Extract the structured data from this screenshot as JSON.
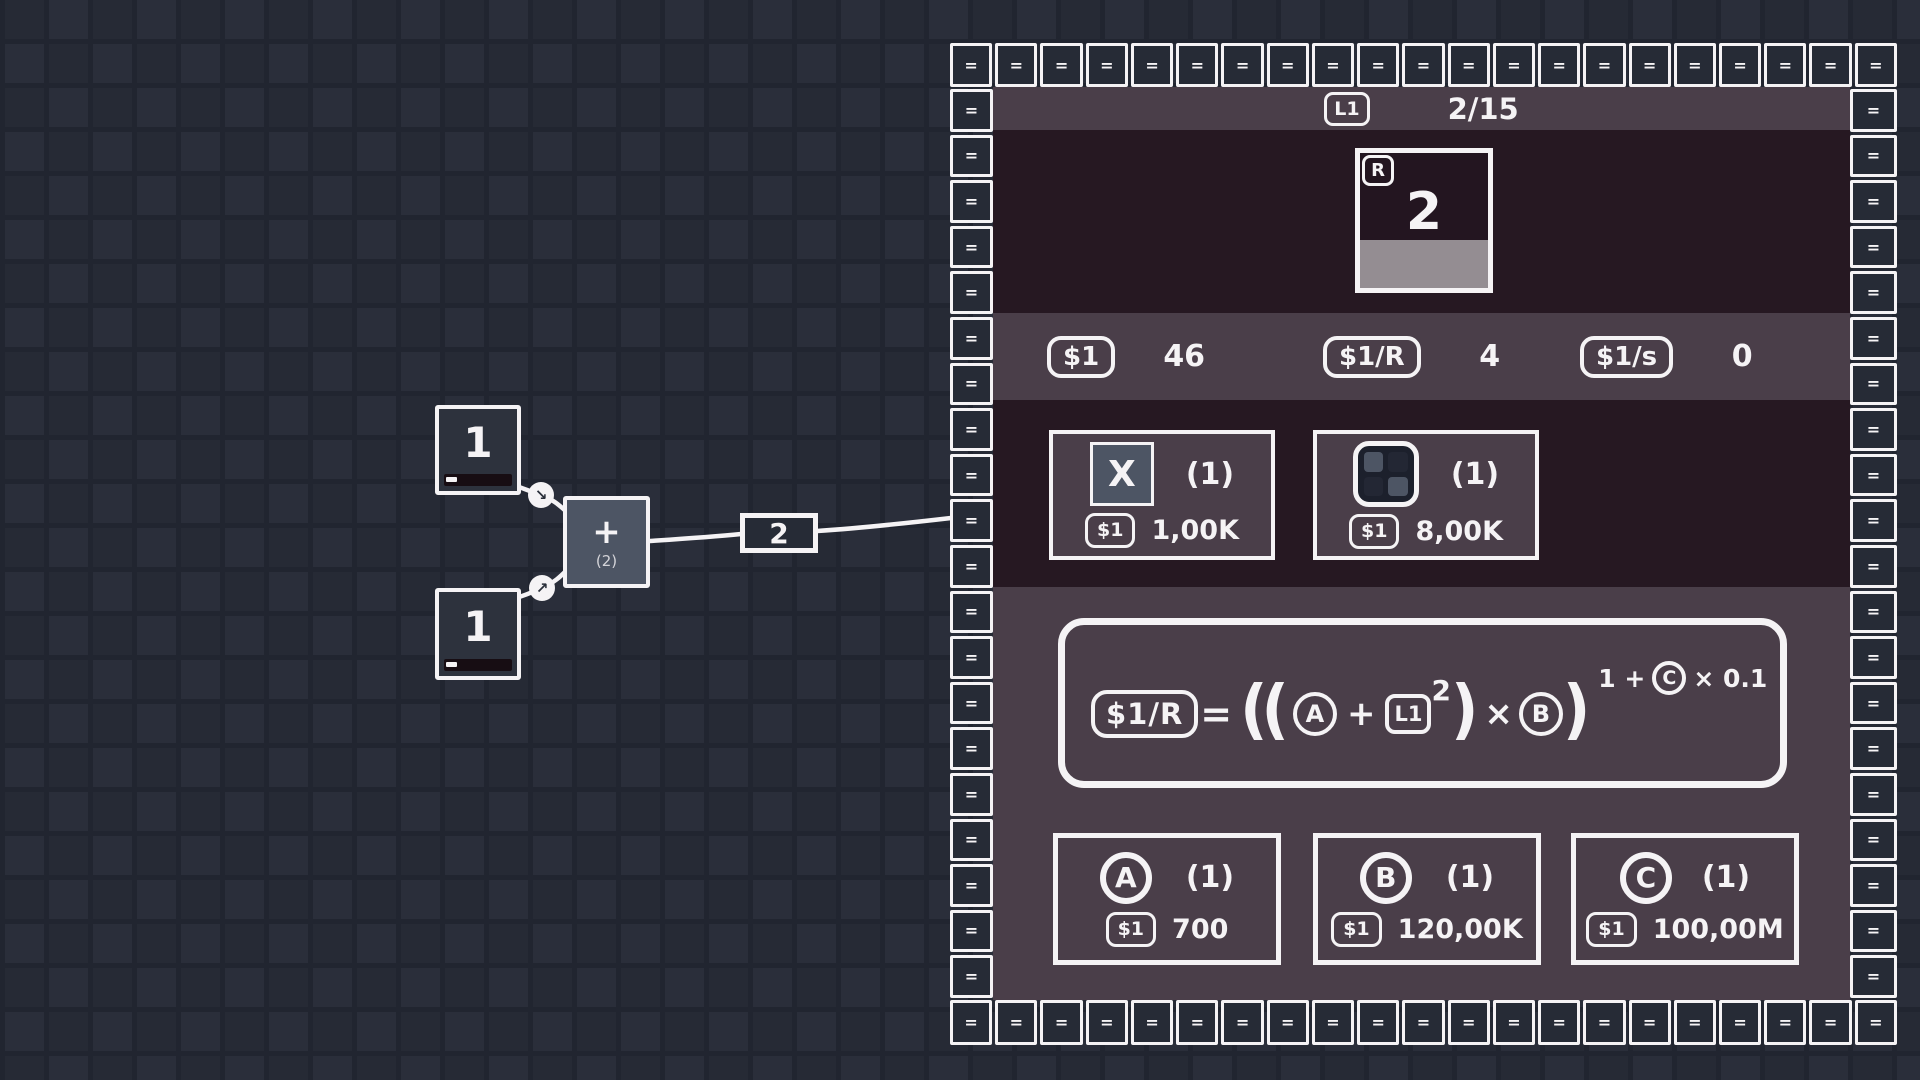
{
  "colors": {
    "background": "#242834",
    "panel_mauve": "#4a3e49",
    "panel_dark_purple": "#261822",
    "slate_accent": "#4d5564",
    "progress_gray": "#948d92",
    "stroke_white": "#f5f3f5"
  },
  "graph": {
    "input_nodes": [
      {
        "value": "1"
      },
      {
        "value": "1"
      }
    ],
    "operator_node": {
      "symbol": "+",
      "annotation": "(2)"
    },
    "edge_value_label": "2",
    "connector_arrows": [
      {
        "name": "arrow-down-right-icon",
        "glyph": "↘"
      },
      {
        "name": "arrow-up-right-icon",
        "glyph": "↗"
      }
    ]
  },
  "panel": {
    "border_tile_glyph": "=",
    "header": {
      "level_badge": "L1",
      "progress": "2/15"
    },
    "card": {
      "corner_badge": "R",
      "value": "2"
    },
    "stats": [
      {
        "unit": "$1",
        "value": "46"
      },
      {
        "unit": "$1/R",
        "value": "4"
      },
      {
        "unit": "$1/s",
        "value": "0"
      }
    ],
    "upgrades": [
      {
        "icon": "x-icon",
        "icon_label": "X",
        "count": "(1)",
        "currency": "$1",
        "cost": "1,00K"
      },
      {
        "icon": "grid-icon",
        "count": "(1)",
        "currency": "$1",
        "cost": "8,00K"
      }
    ],
    "formula": {
      "result": "$1/R",
      "equals": "=",
      "open": "((",
      "var_a": "A",
      "plus": "+",
      "var_l1": "L1",
      "square": "2",
      "close1": ")",
      "times": "×",
      "var_b": "B",
      "close2": ")",
      "exp_pre": "1 +",
      "exp_var": "C",
      "exp_post": "× 0.1"
    },
    "buy_buttons": [
      {
        "letter": "A",
        "count": "(1)",
        "currency": "$1",
        "cost": "700"
      },
      {
        "letter": "B",
        "count": "(1)",
        "currency": "$1",
        "cost": "120,00K"
      },
      {
        "letter": "C",
        "count": "(1)",
        "currency": "$1",
        "cost": "100,00M"
      }
    ]
  }
}
